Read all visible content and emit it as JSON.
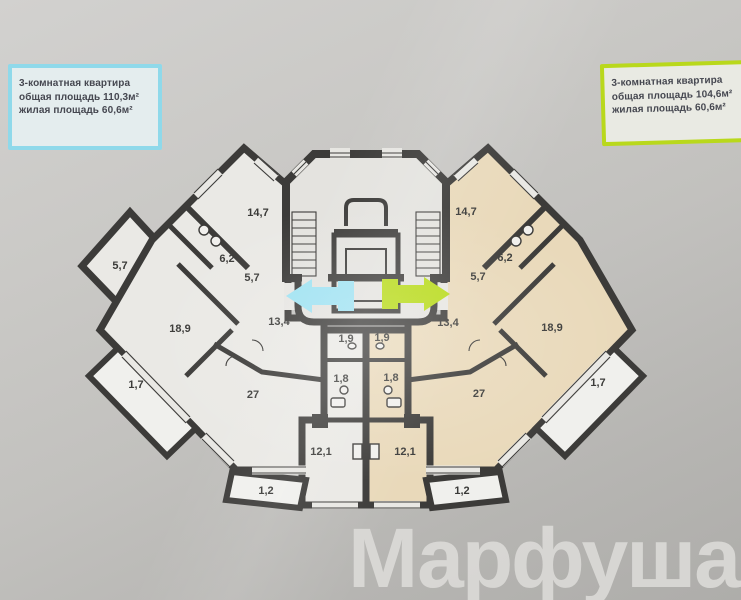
{
  "apartment_cards": {
    "left": {
      "title": "3-комнатная квартира",
      "total_area": "общая площадь 110,3м²",
      "living_area": "жилая площадь 60,6м²",
      "border_color": "#8fd9ea"
    },
    "right": {
      "title": "3-комнатная квартира",
      "total_area": "общая площадь 104,6м²",
      "living_area": "жилая площадь 60,6м²",
      "border_color": "#b9d81c"
    }
  },
  "plan": {
    "wall_color": "#3c3b39",
    "left_apartment_fill": "#eae9e5",
    "right_apartment_fill": "#e9d9ba",
    "balcony_fill": "#f0f0ed",
    "arrow_left_color": "#9fe2f2",
    "arrow_right_color": "#b7da16",
    "room_labels_left": [
      "14,7",
      "6,2",
      "5,7",
      "5,7",
      "18,9",
      "13,4",
      "1,7",
      "27",
      "1,9",
      "1,8",
      "12,1",
      "1,2"
    ],
    "room_labels_right": [
      "14,7",
      "6,2",
      "5,7",
      "18,9",
      "13,4",
      "1,7",
      "27",
      "1,9",
      "1,8",
      "12,1",
      "1,2"
    ]
  },
  "watermark": "Марфуша"
}
